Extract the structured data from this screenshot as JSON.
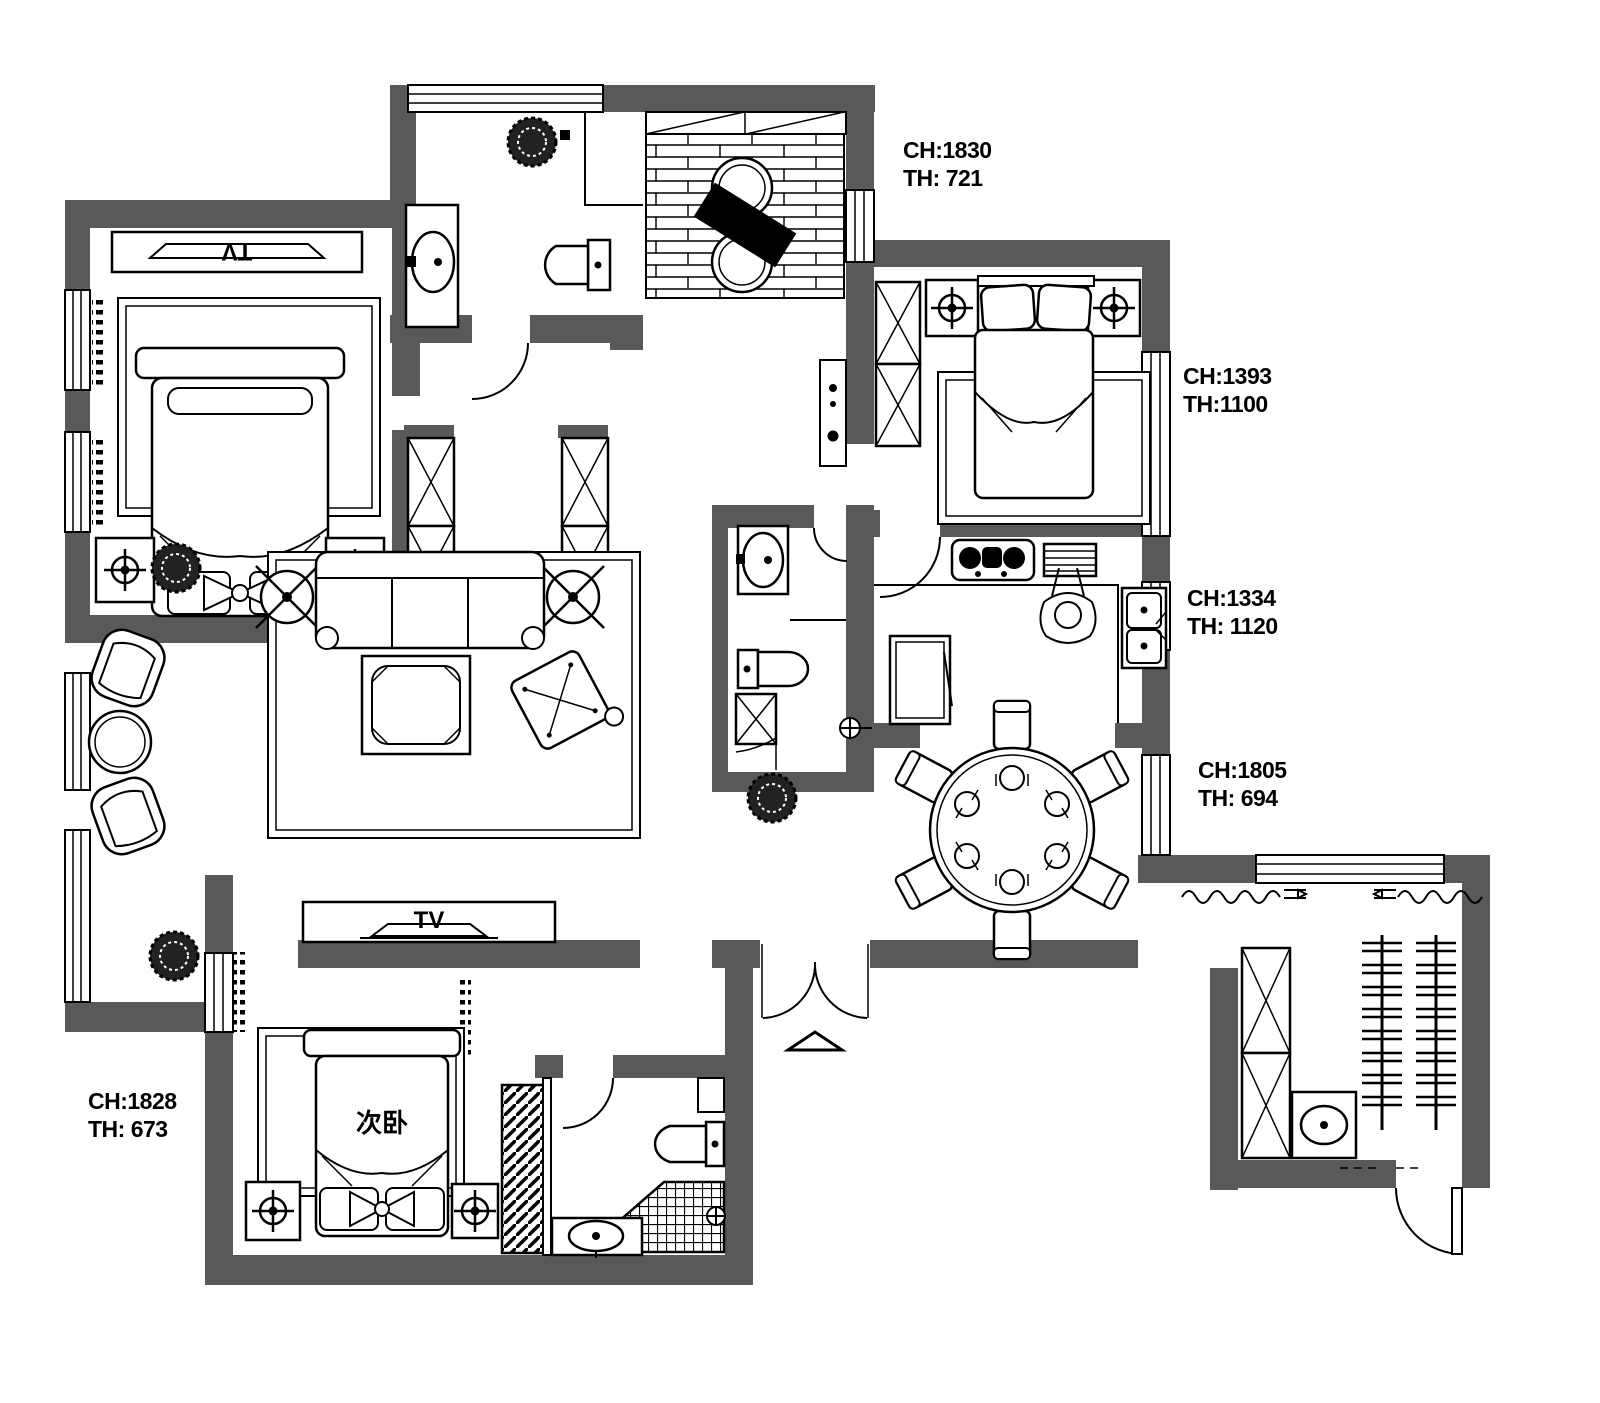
{
  "title": "apartment-floor-plan",
  "colors": {
    "wall": "#595959",
    "line": "#000000",
    "background": "#ffffff"
  },
  "labels": {
    "dims": [
      {
        "id": "dim-top-bath",
        "ch": "CH:1830",
        "th": "TH: 721"
      },
      {
        "id": "dim-bedroom-2",
        "ch": "CH:1393",
        "th": "TH:1100"
      },
      {
        "id": "dim-kitchen",
        "ch": "CH:1334",
        "th": "TH: 1120"
      },
      {
        "id": "dim-dining",
        "ch": "CH:1805",
        "th": "TH: 694"
      },
      {
        "id": "dim-bedroom-3",
        "ch": "CH:1828",
        "th": "TH: 673"
      }
    ],
    "rooms": {
      "master_tv": "TV",
      "living_tv": "TV",
      "secondary_bedroom": "次卧"
    }
  }
}
